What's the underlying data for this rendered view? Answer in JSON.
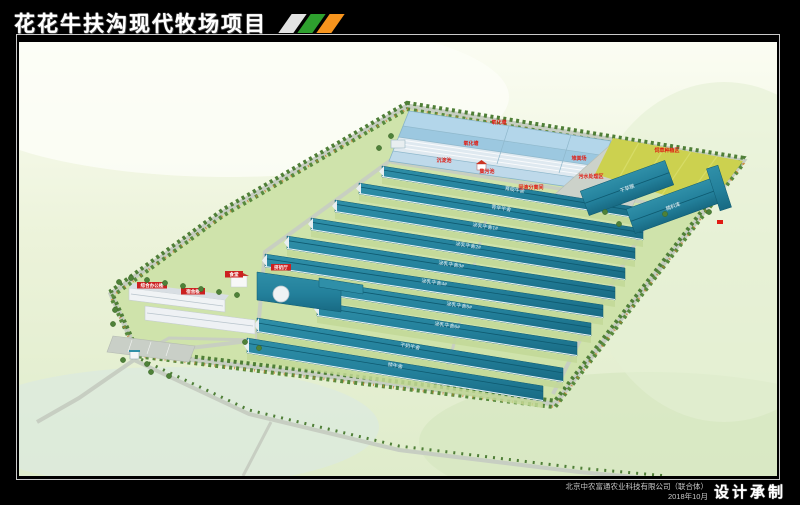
{
  "header": {
    "title": "花花牛扶沟现代牧场项目",
    "logo_stripes": [
      "#e2e2e2",
      "#2ea02e",
      "#f7941d"
    ]
  },
  "footer": {
    "company": "北京中农富通农业科技有限公司（联合体）",
    "date": "2018年10月",
    "credit": "设计承制"
  },
  "scene": {
    "red_labels": [
      "氧化塘",
      "氧化塘",
      "沉淀池",
      "集污池",
      "堆粪场",
      "污水处理区",
      "固液分离间",
      "饲草种植区"
    ],
    "banner_labels": [
      "综合办公楼",
      "宿舍楼",
      "食堂",
      "挤奶厅"
    ],
    "barn_labels": [
      "育成牛舍",
      "青年牛舍",
      "泌乳牛舍1#",
      "泌乳牛舍2#",
      "泌乳牛舍3#",
      "泌乳牛舍4#",
      "泌乳牛舍5#",
      "泌乳牛舍6#",
      "干奶牛舍",
      "犊牛舍"
    ],
    "side_barn_labels": [
      "干草棚",
      "精料库"
    ],
    "colors": {
      "grass_site": "#cfe3ab",
      "barn_teal_light": "#2f8fa8",
      "barn_teal_dark": "#186a83",
      "water": "#9cc8e0",
      "water_light": "#b3d6ea",
      "lagoon_cover": "#dfe9f0",
      "field_yellow": "#ccd14f",
      "road": "#c7cec2",
      "label_red": "#e01b12",
      "tree_green": "#4f7f37",
      "building_white": "#f0f3f5"
    }
  }
}
